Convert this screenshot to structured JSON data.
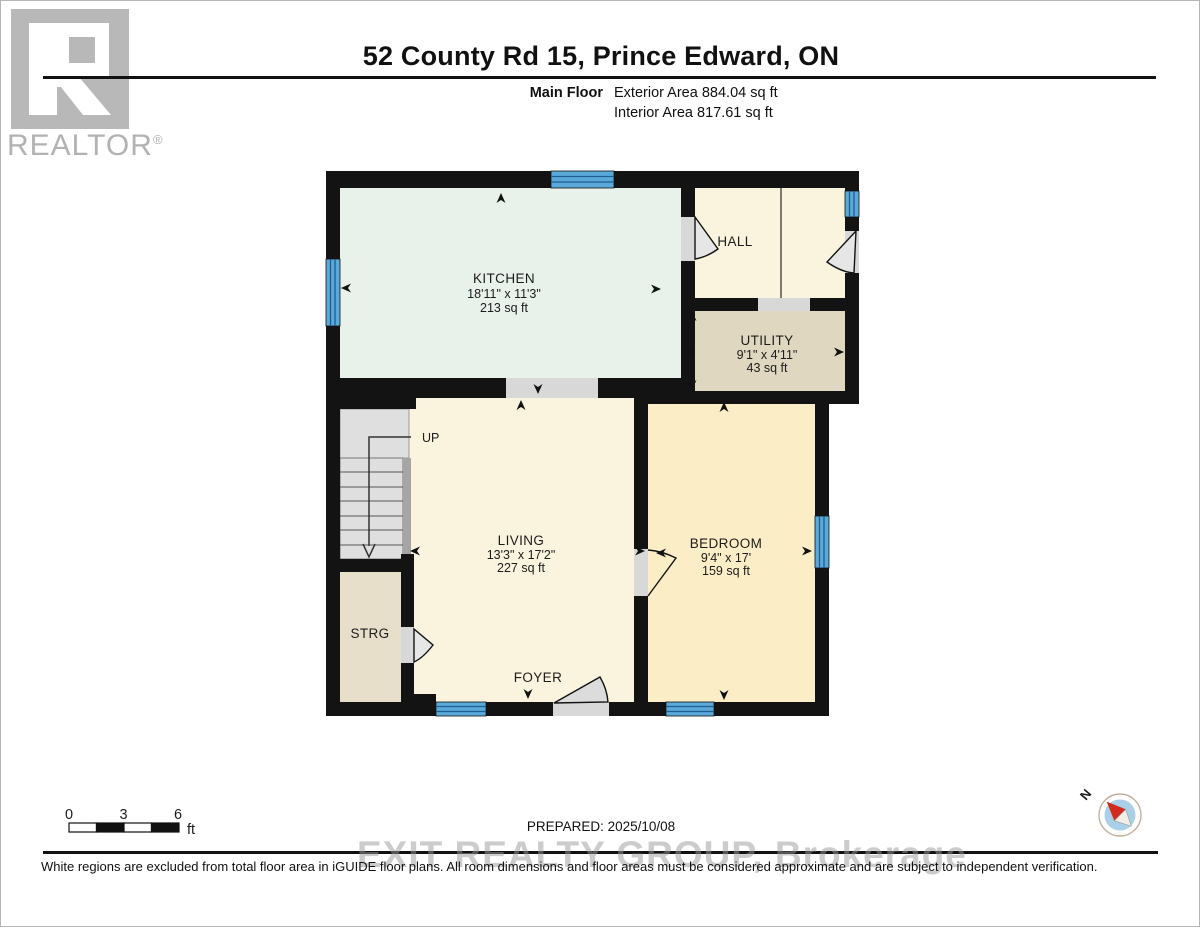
{
  "header": {
    "title": "52 County Rd 15, Prince Edward, ON",
    "floor_label": "Main Floor",
    "exterior_area": "Exterior Area 884.04 sq ft",
    "interior_area": "Interior Area 817.61 sq ft"
  },
  "logo": {
    "wordmark": "REALTOR",
    "registered": "®"
  },
  "rooms": {
    "kitchen": {
      "name": "KITCHEN",
      "dims": "18'11\" x 11'3\"",
      "area": "213 sq ft"
    },
    "hall": {
      "name": "HALL"
    },
    "utility": {
      "name": "UTILITY",
      "dims": "9'1\" x 4'11\"",
      "area": "43 sq ft"
    },
    "living": {
      "name": "LIVING",
      "dims": "13'3\" x 17'2\"",
      "area": "227 sq ft"
    },
    "bedroom": {
      "name": "BEDROOM",
      "dims": "9'4\" x 17'",
      "area": "159 sq ft"
    },
    "storage": {
      "name": "STRG"
    },
    "foyer": {
      "name": "FOYER"
    },
    "stairs": {
      "label": "UP"
    }
  },
  "scale_bar": {
    "tick0": "0",
    "tick1": "3",
    "tick2": "6",
    "unit": "ft"
  },
  "compass": {
    "label": "N"
  },
  "footer": {
    "prepared": "PREPARED: 2025/10/08",
    "watermark": "EXIT REALTY GROUP, Brokerage",
    "disclaimer": "White regions are excluded from total floor area in iGUIDE floor plans. All room dimensions and floor areas must be considered approximate and are subject to independent verification."
  },
  "colors": {
    "wall": "#131313",
    "kitchen": "#e9f1eb",
    "hall": "#faf3dd",
    "living": "#faf3dd",
    "utility": "#e0d7c1",
    "storage": "#e7dfca",
    "bedroom": "#fbedc6",
    "window": "#5ba9d9",
    "window_line": "#1e5c92",
    "stairs": "#dfdfdf",
    "door_gap": "#d8d8d8",
    "compass_needle": "#d42b1e",
    "compass_inner": "#a9cfe9"
  }
}
